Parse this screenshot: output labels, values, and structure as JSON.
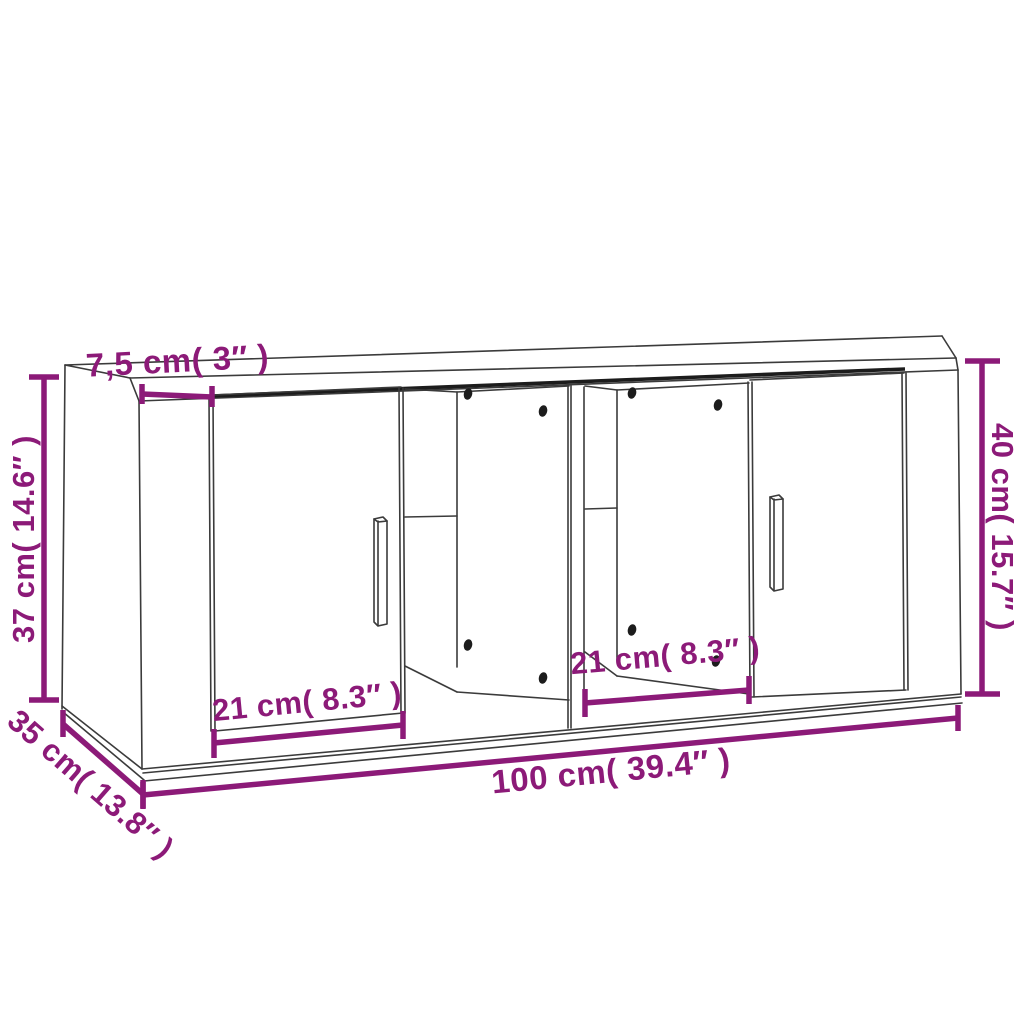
{
  "diagram": {
    "title": "TV cabinet dimension diagram",
    "type": "furniture-dimension-line-drawing",
    "subject": "wall TV cabinet with two doors and two open shelf compartments",
    "colors": {
      "dimension": "#8C1A78",
      "line": "#3B3B3B",
      "shadow": "#1C1C1C",
      "background": "#FFFFFF"
    },
    "labels": {
      "top_depth": "7,5 cm( 3″ )",
      "left_height": "37 cm( 14.6″ )",
      "right_height": "40 cm( 15.7″ )",
      "depth": "35 cm( 13.8″ )",
      "width": "100 cm( 39.4″ )",
      "left_door_width": "21 cm( 8.3″ )",
      "right_opening_width": "21 cm( 8.3″ )"
    }
  }
}
